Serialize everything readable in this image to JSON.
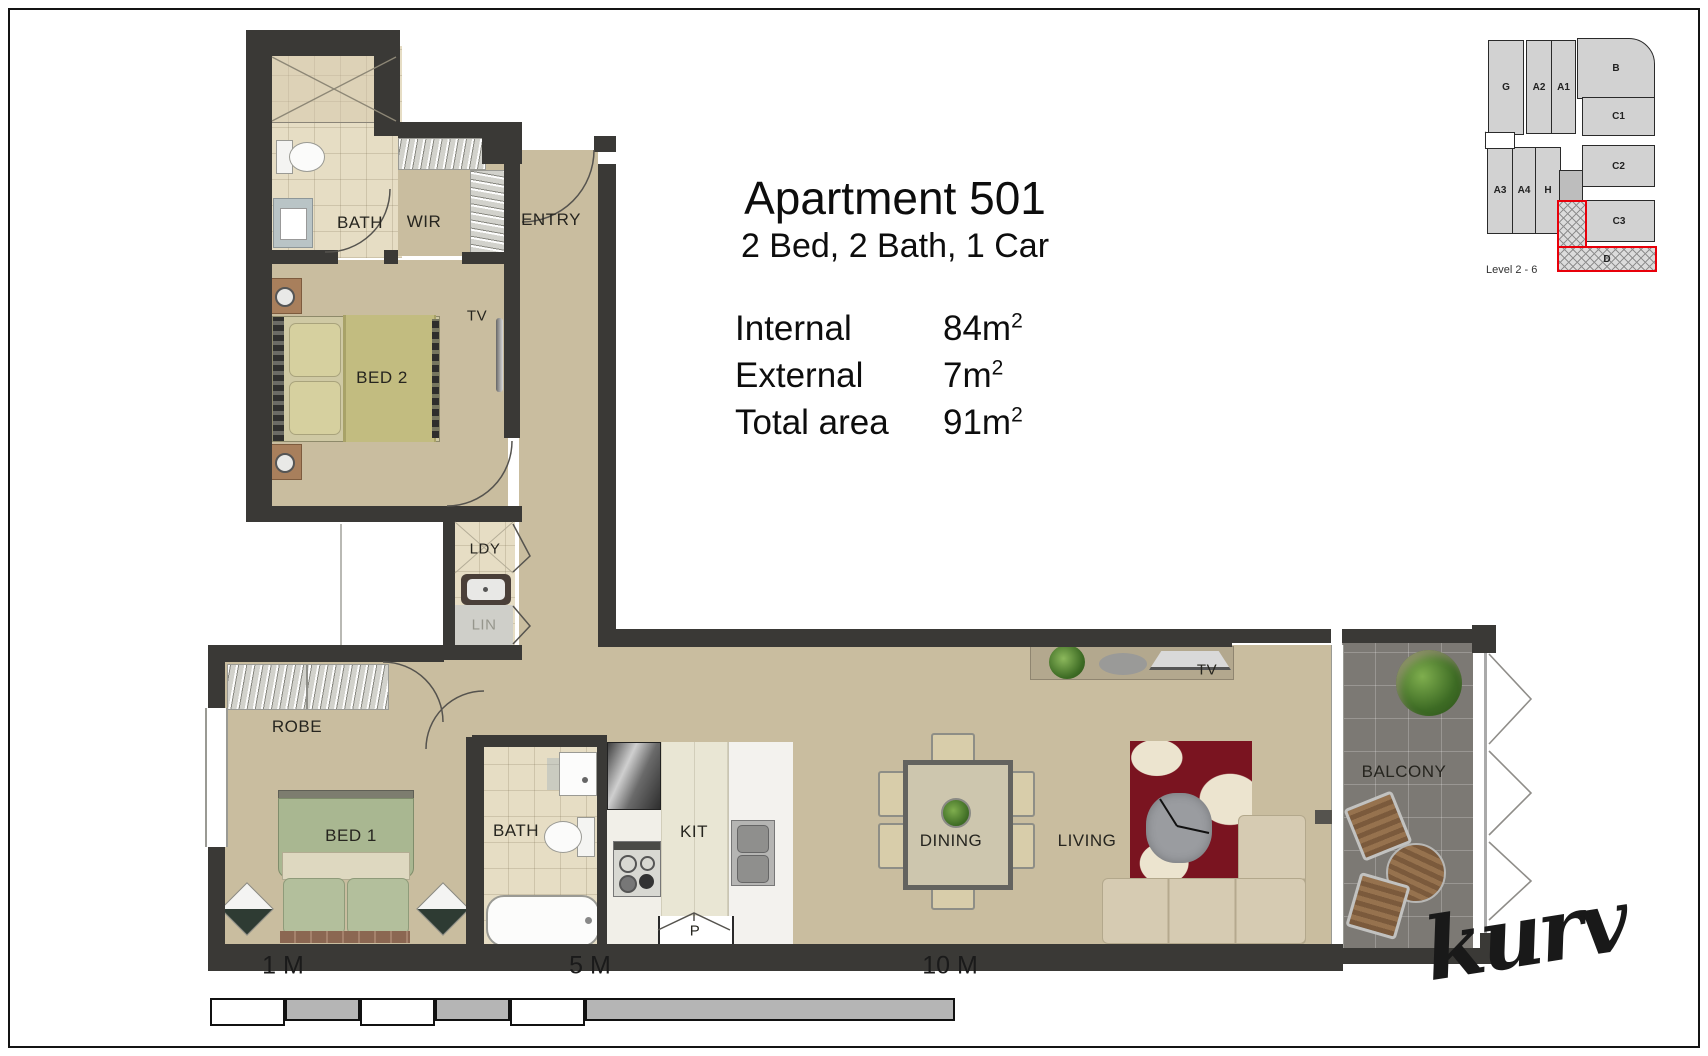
{
  "header": {
    "title": "Apartment 501",
    "subtitle": "2 Bed, 2 Bath, 1 Car"
  },
  "areas": {
    "rows": [
      {
        "label": "Internal",
        "value": "84m",
        "sup": "2"
      },
      {
        "label": "External",
        "value": "7m",
        "sup": "2"
      },
      {
        "label": "Total area",
        "value": "91m",
        "sup": "2"
      }
    ]
  },
  "rooms": {
    "bath_upper": "BATH",
    "wir": "WIR",
    "entry": "ENTRY",
    "tv_bed2": "TV",
    "bed2": "BED 2",
    "ldy": "LDY",
    "lin": "LIN",
    "robe": "ROBE",
    "bed1": "BED 1",
    "bath_lower": "BATH",
    "kit": "KIT",
    "pantry": "P",
    "dining": "DINING",
    "living": "LIVING",
    "tv_living": "TV",
    "balcony": "BALCONY"
  },
  "locator": {
    "level": "Level 2 - 6",
    "units": [
      "G",
      "A2",
      "A1",
      "B",
      "C1",
      "C2",
      "C3",
      "A3",
      "A4",
      "H",
      "D"
    ],
    "highlighted_unit": "D",
    "highlight_color": "#e8000a"
  },
  "scale_bar": {
    "marks": [
      "1 M",
      "5 M",
      "10 M"
    ]
  },
  "branding": {
    "logo": "kurv"
  },
  "colors": {
    "wall": "#3a3936",
    "floor_tan": "#c9bd9f",
    "floor_tile": "#e6ddc4",
    "balcony": "#7c7974",
    "rug_red": "#7a1420",
    "highlight_red": "#e8000a"
  }
}
